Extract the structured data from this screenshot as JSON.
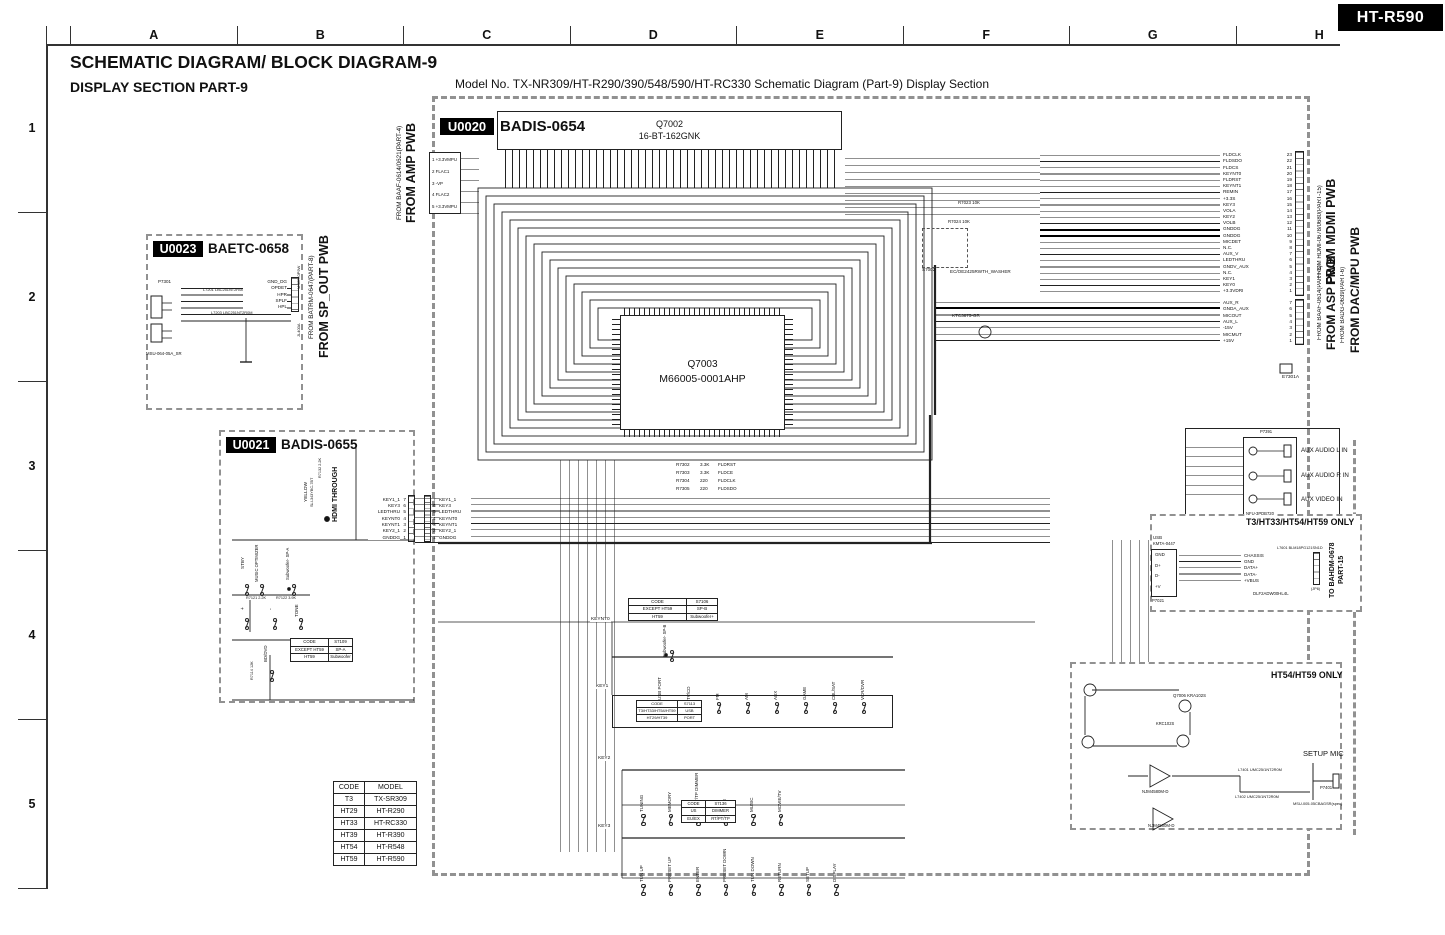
{
  "badge": "HT-R590",
  "header": {
    "title": "SCHEMATIC DIAGRAM/ BLOCK DIAGRAM-9",
    "subtitle": "DISPLAY SECTION  PART-9",
    "model_line": "Model No. TX-NR309/HT-R290/390/548/590/HT-RC330 Schematic Diagram (Part-9) Display Section"
  },
  "grid": {
    "cols": [
      "A",
      "B",
      "C",
      "D",
      "E",
      "F",
      "G",
      "H"
    ],
    "rows": [
      "1",
      "2",
      "3",
      "4",
      "5"
    ]
  },
  "u0020": {
    "id": "U0020",
    "name": "BADIS-0654",
    "q7002": {
      "ref": "Q7002",
      "part": "16-BT-162GNK"
    },
    "q7003": {
      "ref": "Q7003",
      "part": "M66005-0001AHP"
    },
    "amp_pwb_small": "FROM BAAF-0614/0621(PART-4)",
    "amp_pwb_big": "FROM AMP PWB",
    "amp_pins": [
      "1 +3.3VMPU",
      "2 FLAC1",
      "3 -VP",
      "4 FLAC2",
      "5 +3.3VMPU"
    ],
    "s7002": {
      "ref": "S7002",
      "part": "EC/OE2425RWTH_WASHER"
    },
    "q7101_part": "KTC3875-GR",
    "r7023": "R7023 10K",
    "r7024": "R7024 10K",
    "fl_lines": [
      {
        "r": "R7302",
        "v": "3.3K",
        "s": "FLDRST"
      },
      {
        "r": "R7303",
        "v": "3.3K",
        "s": "FLDCE"
      },
      {
        "r": "R7304",
        "v": "220",
        "s": "FLDCLK"
      },
      {
        "r": "R7305",
        "v": "220",
        "s": "FLDSDO"
      }
    ],
    "keynt0": "KEYNT0",
    "e7301a": "E7301A"
  },
  "u0023": {
    "id": "U0023",
    "name": "BAETC-0658",
    "pins": [
      "GND_DG",
      "OPDET",
      "HPR",
      "SPLF",
      "HPL"
    ],
    "p7301": "P7301",
    "jack_part": "MSU-064-05A_SR",
    "l1": "L7201 LBC251NT2R0M",
    "l2": "L7203 LBC251NT2R0M",
    "spout_small": "FROM BATRM-0647(PART-8)",
    "spout_big": "FROM SP_OUT PWB",
    "msct": "MSCT-0P9W",
    "jl": "JL400A"
  },
  "u0021": {
    "id": "U0021",
    "name": "BADIS-0655",
    "yellow": "YELLOW",
    "led_part": "SLI-343YBC-7BT",
    "r7132": "R7132 2.2K",
    "hdmi_through": "HDMI THROUGH",
    "sw_row1": [
      "STBY",
      "MUSIC OPTIMIZER",
      "Subwoofer- SP-A"
    ],
    "sw_row2": [
      "+",
      "-",
      "TONE"
    ],
    "sw_row3": [
      "BD/DVD"
    ],
    "r7121": "R7121 2.2K",
    "r7122": "R7122 3.9K",
    "r7114": "R7114 12K",
    "table": [
      [
        "CODE",
        "S7109"
      ],
      [
        "EXCEPT HT59",
        "SP-A"
      ],
      [
        "HT59",
        "Subwoofer"
      ]
    ],
    "keys": [
      {
        "n": "7",
        "s": "KEY1_1"
      },
      {
        "n": "6",
        "s": "KEY3"
      },
      {
        "n": "5",
        "s": "LEDTHRU"
      },
      {
        "n": "4",
        "s": "KEYNT0"
      },
      {
        "n": "3",
        "s": "KEYNT1"
      },
      {
        "n": "2",
        "s": "KEY2_1"
      },
      {
        "n": "1",
        "s": "GNDDG"
      }
    ]
  },
  "switch_rows": {
    "key1_label": "KEY1",
    "key2_label": "KEY2",
    "key3_label": "KEY3",
    "row1": [
      "USB PORT",
      "TV/CD",
      "FM",
      "AM",
      "AUX",
      "GAME",
      "CBL/SAT",
      "VCR/DVR"
    ],
    "row2": [
      "TUNING",
      "MEMORY",
      "RT/PT/TP DIMMER",
      "GAME",
      "MUSIC",
      "MOVIE/TV"
    ],
    "row3": [
      "TUN UP",
      "PRESET UP",
      "ENTER",
      "PRESET DOWN",
      "TUN DOWN",
      "RETURN",
      "SETUP",
      "DISPLAY"
    ],
    "sub_sp_b": "Subwoofer- SP-B",
    "table_s7106": [
      [
        "CODE",
        "S7106"
      ],
      [
        "EXCEPT HT59",
        "SP-B"
      ],
      [
        "HT59",
        "Subwoofer+"
      ]
    ],
    "table_s7113": [
      [
        "CODE",
        "S7113"
      ],
      [
        "T3/HT33/HT54/HT59",
        "USB"
      ],
      [
        "HT29/HT39",
        "PORT"
      ]
    ],
    "table_s7136": [
      [
        "CODE",
        "S7136"
      ],
      [
        "US",
        "DIMMER"
      ],
      [
        "EU/EX",
        "RT/PT/TP"
      ]
    ]
  },
  "right": {
    "mdmi_small": "FROM HDMI-0678/0680(PART-15)",
    "mdmi_big": "FROM MDMI PWB",
    "asp_small": "FROM BAAF-0614(PART-3)",
    "asp_big": "FROM ASP PWB",
    "dac_small": "FROM BADG-0639(PART-6)",
    "dac_big": "FROM DAC/MPU PWB",
    "conn1": [
      {
        "n": "23",
        "s": "FLDCLK"
      },
      {
        "n": "22",
        "s": "FLDSDO"
      },
      {
        "n": "21",
        "s": "FLDCS"
      },
      {
        "n": "20",
        "s": "KEYNT0"
      },
      {
        "n": "19",
        "s": "FLDRST"
      },
      {
        "n": "18",
        "s": "KEYNT1"
      },
      {
        "n": "17",
        "s": "REMIN"
      },
      {
        "n": "16",
        "s": "+3.3S"
      },
      {
        "n": "15",
        "s": "KEY3"
      },
      {
        "n": "14",
        "s": "VOLA"
      },
      {
        "n": "13",
        "s": "KEY2"
      },
      {
        "n": "12",
        "s": "VOLB"
      },
      {
        "n": "11",
        "s": "GNDDG"
      },
      {
        "n": "10",
        "s": "GNDDG"
      },
      {
        "n": "9",
        "s": "MICDET"
      },
      {
        "n": "8",
        "s": "N.C."
      },
      {
        "n": "7",
        "s": "AUX_V"
      },
      {
        "n": "6",
        "s": "LEDTHRU"
      },
      {
        "n": "5",
        "s": "GNDV_AUX"
      },
      {
        "n": "4",
        "s": "N.C."
      },
      {
        "n": "3",
        "s": "KEY1"
      },
      {
        "n": "2",
        "s": "KEY0"
      },
      {
        "n": "1",
        "s": "+3.3VDRI"
      }
    ],
    "conn2": [
      {
        "n": "7",
        "s": "AUX_R"
      },
      {
        "n": "6",
        "s": "GNDA_AUX"
      },
      {
        "n": "5",
        "s": "MICOUT"
      },
      {
        "n": "4",
        "s": "AUX_L"
      },
      {
        "n": "3",
        "s": "-15V"
      },
      {
        "n": "2",
        "s": "MICMUT"
      },
      {
        "n": "1",
        "s": "+15V"
      }
    ]
  },
  "aux": {
    "p7391": "P7391",
    "part": "NFU-3PDB720",
    "jacks": [
      "AUX AUDIO L IN",
      "AUX AUDIO R IN",
      "AUX VIDEO IN"
    ]
  },
  "t3": {
    "title": "T3/HT33/HT54/HT59 ONLY",
    "usb": "USB",
    "usb_part": "KMTA-0447",
    "usb_pins": [
      "GND",
      "D+",
      "D-",
      "+V"
    ],
    "p7021": "P7021",
    "signals": [
      "CHASSIS",
      "GND",
      "DATA+",
      "DATA-",
      "+VBUS"
    ],
    "l7601": "L7601 BLM18PG121SN1D",
    "filter": "DLF2ADW00HL4L",
    "jp6": "(JP6)",
    "to_line1": "TO BAHDM-0678",
    "to_line2": "PART-15"
  },
  "ht54": {
    "title": "HT54/HT59 ONLY",
    "setup_mic": "SETUP MIC",
    "q7006": "Q7006 KRA102S",
    "krc": "KRC102S",
    "opamp": "NJM4580M-D",
    "l7401": "L7401 UMC25/1NT2R0M",
    "l7402": "L7402 UMC25/1NT2R0M",
    "p7401": "P7401",
    "mic_part": "MSU-005-05CBAGSR(spec)"
  },
  "model_table": {
    "headers": [
      "CODE",
      "MODEL"
    ],
    "rows": [
      [
        "T3",
        "TX-SR309"
      ],
      [
        "HT29",
        "HT-R290"
      ],
      [
        "HT33",
        "HT-RC330"
      ],
      [
        "HT39",
        "HT-R390"
      ],
      [
        "HT54",
        "HT-R548"
      ],
      [
        "HT59",
        "HT-R590"
      ]
    ]
  }
}
